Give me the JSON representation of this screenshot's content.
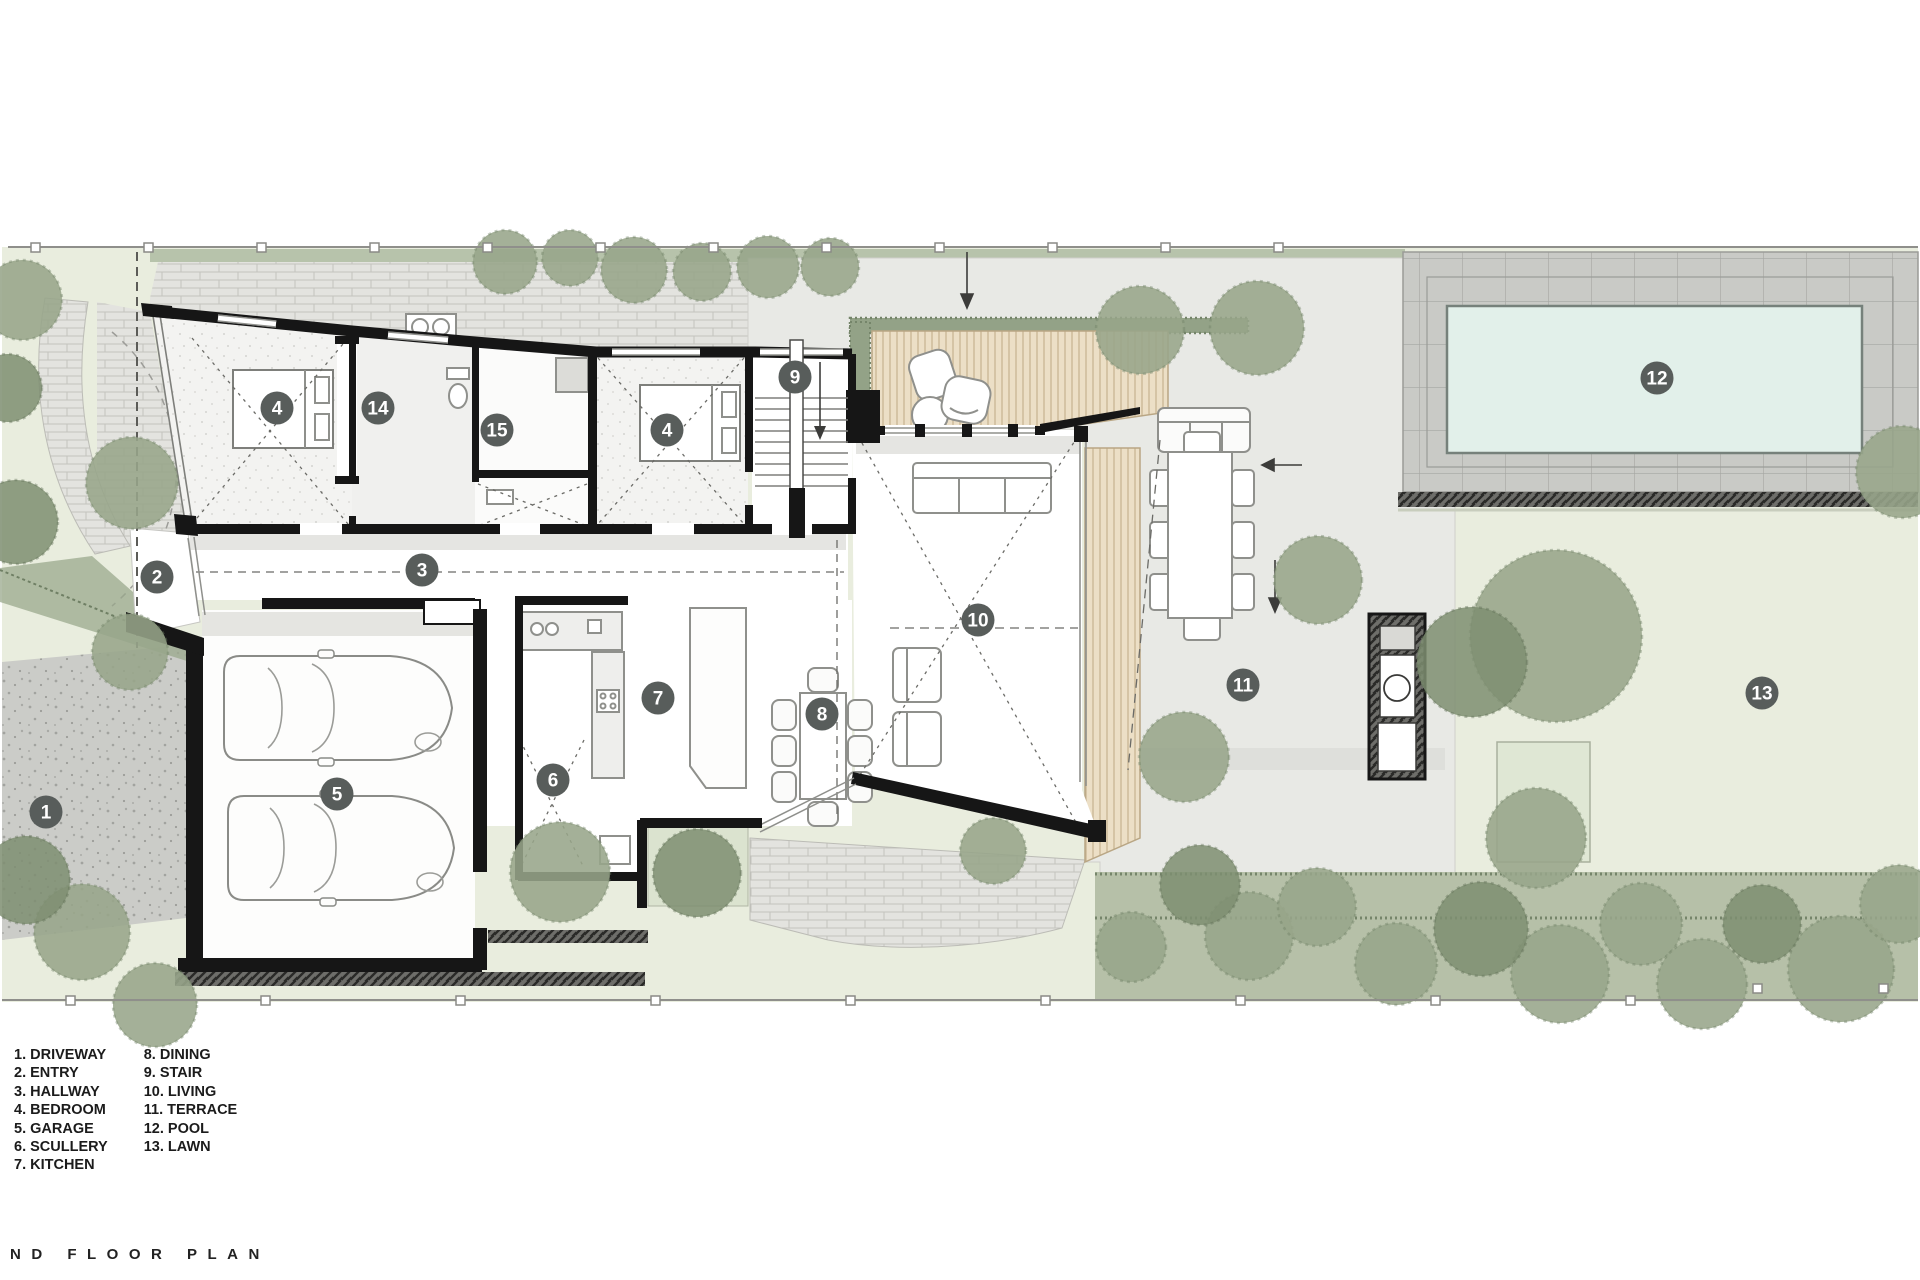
{
  "title": "ND FLOOR PLAN",
  "legend": {
    "col1": [
      {
        "num": "1.",
        "label": "DRIVEWAY"
      },
      {
        "num": "2.",
        "label": "ENTRY"
      },
      {
        "num": "3.",
        "label": "HALLWAY"
      },
      {
        "num": "4.",
        "label": "BEDROOM"
      },
      {
        "num": "5.",
        "label": "GARAGE"
      },
      {
        "num": "6.",
        "label": "SCULLERY"
      },
      {
        "num": "7.",
        "label": "KITCHEN"
      }
    ],
    "col2": [
      {
        "num": "8.",
        "label": "DINING"
      },
      {
        "num": "9.",
        "label": "STAIR"
      },
      {
        "num": "10.",
        "label": "LIVING"
      },
      {
        "num": "11.",
        "label": "TERRACE"
      },
      {
        "num": "12.",
        "label": "POOL"
      },
      {
        "num": "13.",
        "label": "LAWN"
      }
    ]
  },
  "markers": [
    {
      "n": "1",
      "x": 46,
      "y": 812
    },
    {
      "n": "2",
      "x": 157,
      "y": 577
    },
    {
      "n": "3",
      "x": 422,
      "y": 570
    },
    {
      "n": "4",
      "x": 277,
      "y": 408
    },
    {
      "n": "4",
      "x": 667,
      "y": 430
    },
    {
      "n": "5",
      "x": 337,
      "y": 794
    },
    {
      "n": "6",
      "x": 553,
      "y": 780
    },
    {
      "n": "7",
      "x": 658,
      "y": 698
    },
    {
      "n": "8",
      "x": 822,
      "y": 714
    },
    {
      "n": "9",
      "x": 795,
      "y": 377
    },
    {
      "n": "10",
      "x": 978,
      "y": 620
    },
    {
      "n": "11",
      "x": 1243,
      "y": 685
    },
    {
      "n": "12",
      "x": 1657,
      "y": 378
    },
    {
      "n": "13",
      "x": 1762,
      "y": 693
    },
    {
      "n": "14",
      "x": 378,
      "y": 408
    },
    {
      "n": "15",
      "x": 497,
      "y": 430
    }
  ],
  "palette": {
    "marker_fill": "#585d5b",
    "pool_water": "#e2f0ea",
    "timber_deck": "#ecdfc6",
    "tree_green": "#97a58a",
    "lawn_green": "#e9edde",
    "wall_black": "#161616"
  }
}
